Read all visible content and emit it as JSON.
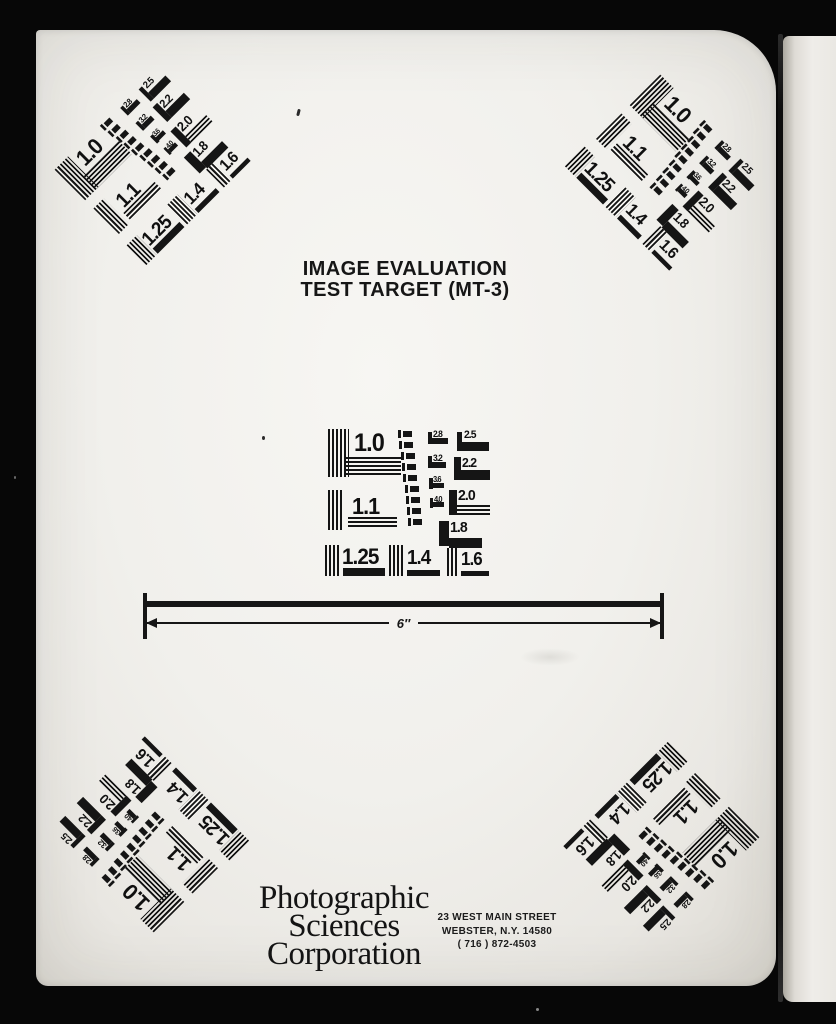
{
  "page": {
    "title_line1": "IMAGE EVALUATION",
    "title_line2": "TEST TARGET (MT-3)",
    "scale_label": "6″",
    "logo_lines": [
      "Photographic",
      "Sciences",
      "Corporation"
    ],
    "address_lines": [
      "23 WEST MAIN STREET",
      "WEBSTER, N.Y. 14580",
      "( 716 ) 872-4503"
    ]
  },
  "test_pattern": {
    "large_labels": [
      "1.0",
      "1.1",
      "1.25",
      "1.4",
      "1.6"
    ],
    "medium_labels": [
      "2.5",
      "2.2",
      "2.0",
      "1.8"
    ],
    "small_labels": [
      "2.8",
      "3.2",
      "3.6",
      "4.0"
    ],
    "micro_bar_count": 9,
    "instances": [
      {
        "position": "center",
        "rotation_deg": 0
      },
      {
        "position": "top-left",
        "rotation_deg": -45
      },
      {
        "position": "top-right",
        "rotation_deg": 45
      },
      {
        "position": "bottom-left",
        "rotation_deg": -135
      },
      {
        "position": "bottom-right",
        "rotation_deg": 135
      }
    ]
  },
  "colors": {
    "frame_black": "#070707",
    "page_white": "#f1f0ec",
    "ink_black": "#141414"
  }
}
